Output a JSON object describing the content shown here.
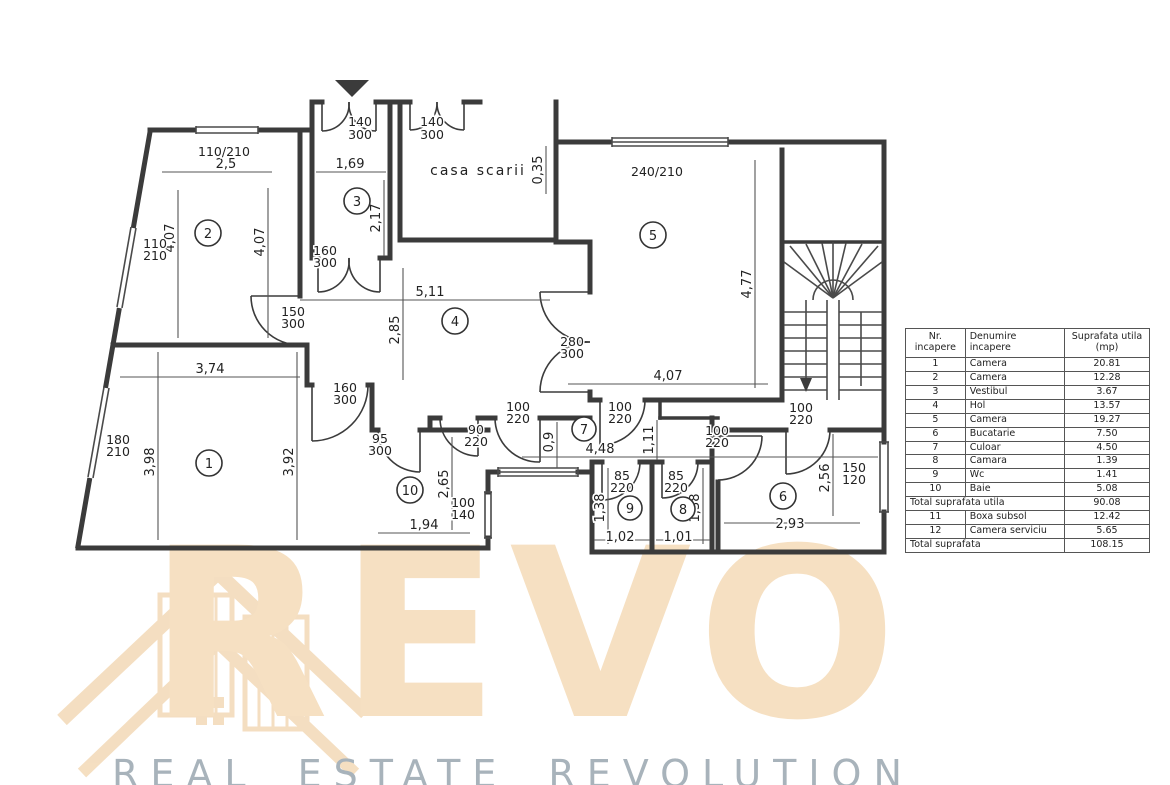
{
  "plan": {
    "staircase_label": "casa scarii",
    "rooms": [
      "1",
      "2",
      "3",
      "4",
      "5",
      "6",
      "7",
      "8",
      "9",
      "10"
    ],
    "dims": {
      "room2_width": "2,5",
      "room2_left": "4,07",
      "room2_right": "4,07",
      "vestibul_width": "1,69",
      "vestibul_height": "2,17",
      "wall_thickness": "0,35",
      "hol_width": "5,11",
      "hol_height": "2,85",
      "room1_width": "3,74",
      "room1_left": "3,98",
      "room1_right": "3,92",
      "room5_width": "4,07",
      "room5_height": "4,77",
      "baie_height": "2,65",
      "baie_width": "1,94",
      "culoar_width": "0,9",
      "culoar_length": "4,48",
      "lobby_height": "1,11",
      "wc_height": "1,38",
      "wc_width": "1,02",
      "camara_height": "1,38",
      "camara_width": "1,01",
      "bucatarie_width": "2,93",
      "bucatarie_height": "2,56"
    },
    "openings": {
      "entrance_door": [
        "140",
        "300"
      ],
      "stair_door": [
        "140",
        "300"
      ],
      "window_room2_top": "110/210",
      "window_room2_side": [
        "110",
        "210"
      ],
      "window_room1_side": [
        "180",
        "210"
      ],
      "window_room5": "240/210",
      "vestibul_door": [
        "160",
        "300"
      ],
      "room2_door": [
        "150",
        "300"
      ],
      "room1_door": [
        "160",
        "300"
      ],
      "baie_door": [
        "95",
        "300"
      ],
      "culoar_door90": [
        "90",
        "220"
      ],
      "culoar_door100a": [
        "100",
        "220"
      ],
      "culoar_door100b": [
        "100",
        "220"
      ],
      "bucatarie_door": [
        "100",
        "220"
      ],
      "scara_door": [
        "100",
        "220"
      ],
      "wc_door": [
        "85",
        "220"
      ],
      "camara_door": [
        "85",
        "220"
      ],
      "room5_door": [
        "280",
        "300"
      ],
      "window_baie": [
        "100",
        "140"
      ],
      "window_bucatarie": [
        "150",
        "120"
      ]
    },
    "line_color": "#3b3b3b"
  },
  "table": {
    "headers": [
      [
        "Nr.",
        "incapere"
      ],
      [
        "Denumire",
        "incapere"
      ],
      [
        "Suprafata utila",
        "(mp)"
      ]
    ],
    "rows": [
      {
        "nr": "1",
        "name": "Camera",
        "area": "20.81"
      },
      {
        "nr": "2",
        "name": "Camera",
        "area": "12.28"
      },
      {
        "nr": "3",
        "name": "Vestibul",
        "area": "3.67"
      },
      {
        "nr": "4",
        "name": "Hol",
        "area": "13.57"
      },
      {
        "nr": "5",
        "name": "Camera",
        "area": "19.27"
      },
      {
        "nr": "6",
        "name": "Bucatarie",
        "area": "7.50"
      },
      {
        "nr": "7",
        "name": "Culoar",
        "area": "4.50"
      },
      {
        "nr": "8",
        "name": "Camara",
        "area": "1.39"
      },
      {
        "nr": "9",
        "name": "Wc",
        "area": "1.41"
      },
      {
        "nr": "10",
        "name": "Baie",
        "area": "5.08"
      }
    ],
    "total_utila": {
      "label": "Total suprafata utila",
      "value": "90.08"
    },
    "extra_rows": [
      {
        "nr": "11",
        "name": "Boxa subsol",
        "area": "12.42"
      },
      {
        "nr": "12",
        "name": "Camera serviciu",
        "area": "5.65"
      }
    ],
    "total": {
      "label": "Total suprafata",
      "value": "108.15"
    }
  },
  "watermark": {
    "logo_text": "REVO",
    "tagline": "REAL ESTATE REVOLUTION",
    "accent_color": "#f6e0c2",
    "logo_color": "#f2d7b2",
    "tagline_color": "#a8b3bb"
  }
}
